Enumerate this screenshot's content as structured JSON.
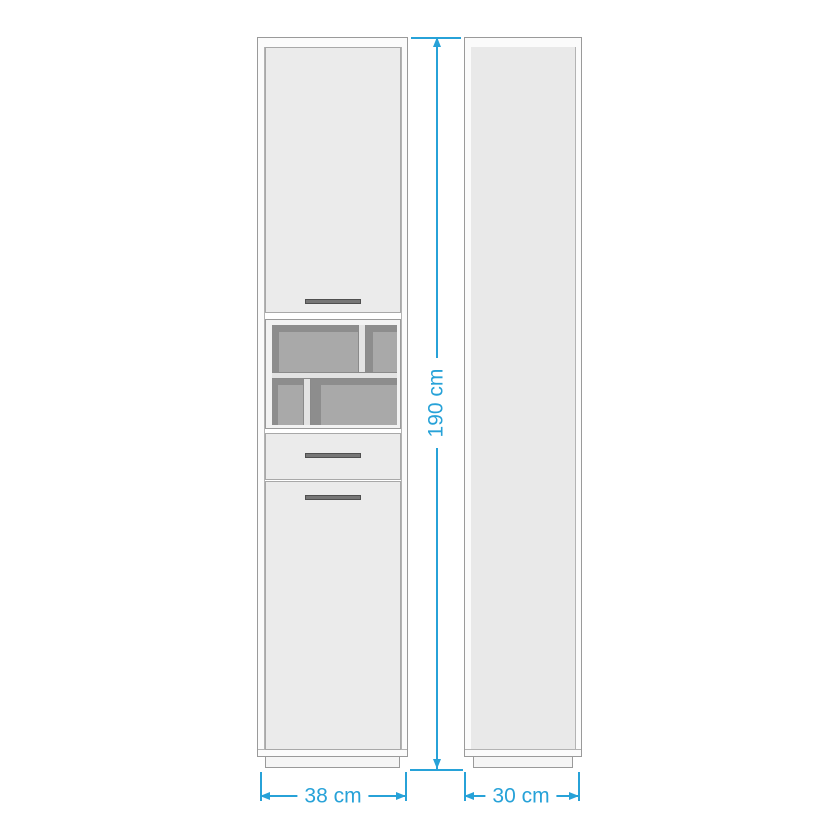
{
  "diagram": {
    "height_label": "190 cm",
    "front_width_label": "38 cm",
    "side_depth_label": "30 cm"
  },
  "colors": {
    "dimension": "#27a2d8",
    "body_fill": "#ebebeb",
    "side_fill": "#e9e9e9",
    "outline": "#9a9a9a",
    "niche_base": "#8d8d8d",
    "niche_panel": "#a9a9a9",
    "niche_trim": "#e3e3e3",
    "handle_fill": "#767676",
    "plinth_fill": "#f5f5f5"
  }
}
